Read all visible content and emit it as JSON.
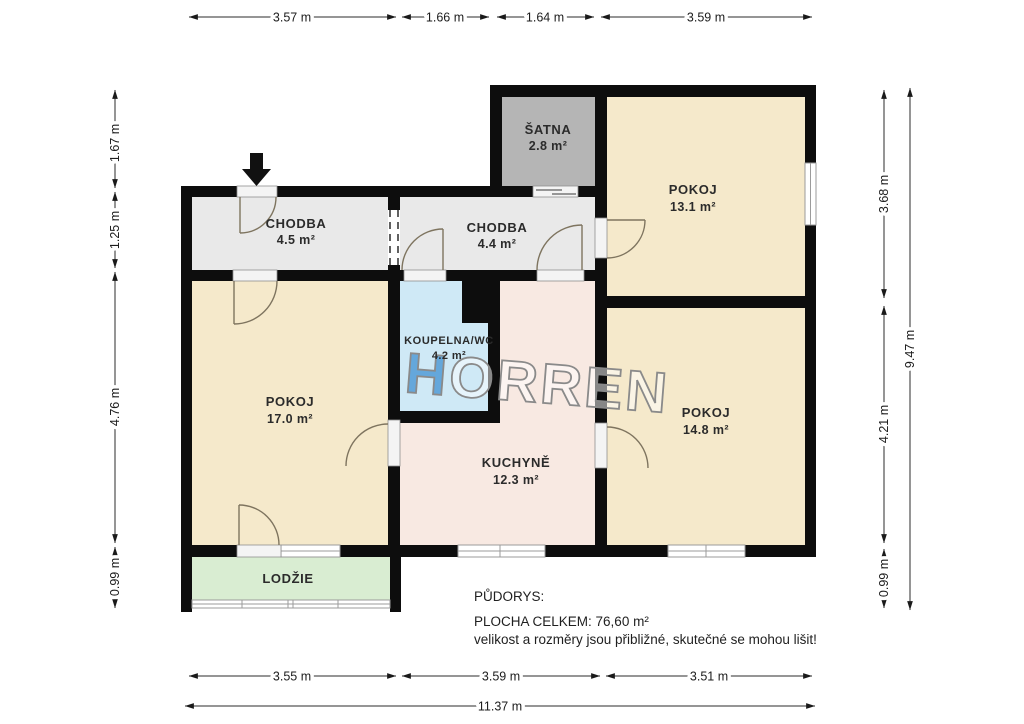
{
  "plan": {
    "watermark": {
      "text": "HORREN",
      "first": "H",
      "rest": "ORREN"
    },
    "rooms": {
      "satna": {
        "name": "ŠATNA",
        "area": "2.8 m²"
      },
      "pokoj_131": {
        "name": "POKOJ",
        "area": "13.1 m²"
      },
      "chodba_45": {
        "name": "CHODBA",
        "area": "4.5 m²"
      },
      "chodba_44": {
        "name": "CHODBA",
        "area": "4.4 m²"
      },
      "koupelna": {
        "name": "KOUPELNA/WC",
        "area": "4.2 m²"
      },
      "pokoj_17": {
        "name": "POKOJ",
        "area": "17.0 m²"
      },
      "kuchyne": {
        "name": "KUCHYNĚ",
        "area": "12.3 m²"
      },
      "pokoj_148": {
        "name": "POKOJ",
        "area": "14.8 m²"
      },
      "lodzie": {
        "name": "LODŽIE"
      }
    },
    "dimensions": {
      "top": [
        "3.57 m",
        "1.66 m",
        "1.64 m",
        "3.59 m"
      ],
      "left": [
        "1.67 m",
        "1.25 m",
        "4.76 m",
        "0.99 m"
      ],
      "right": [
        "3.68 m",
        "4.21 m",
        "0.99 m"
      ],
      "right_total": "9.47 m",
      "bottom": [
        "3.55 m",
        "3.59 m",
        "3.51 m"
      ],
      "bottom_total": "11.37 m"
    },
    "footer": {
      "title": "PŮDORYS:",
      "total_area": "PLOCHA CELKEM: 76,60  m²",
      "disclaimer": "velikost a rozměry jsou přibližné, skutečné se mohou lišit!"
    },
    "colors": {
      "room_beige": "#f5e9cb",
      "hallway_gray": "#e9e9e9",
      "wardrobe_gray": "#b5b5b5",
      "bathroom_blue": "#cfe9f6",
      "kitchen_pink": "#f8e9e2",
      "loggia_green": "#d9edd2",
      "wall_black": "#0d0d0d"
    }
  }
}
